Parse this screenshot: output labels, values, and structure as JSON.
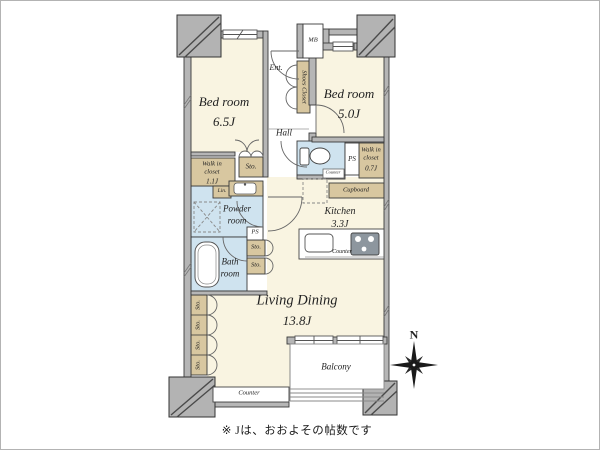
{
  "rooms": {
    "bedroom_a": {
      "name": "Bed room",
      "size": "6.5J"
    },
    "bedroom_b": {
      "name": "Bed room",
      "size": "5.0J"
    },
    "living_dining": {
      "name": "Living Dining",
      "size": "13.8J"
    },
    "kitchen": {
      "name": "Kitchen",
      "size": "3.3J"
    },
    "bath": {
      "line1": "Bath",
      "line2": "room"
    },
    "powder": {
      "line1": "Powder",
      "line2": "room"
    },
    "hall": {
      "name": "Hall"
    },
    "entrance": {
      "name": "Ent."
    },
    "balcony": {
      "name": "Balcony"
    },
    "wic_a": {
      "line1": "Walk in",
      "line2": "closet",
      "size": "1.1J"
    },
    "wic_b": {
      "line1": "Walk in",
      "line2": "closet",
      "size": "0.7J"
    }
  },
  "labels": {
    "mb": "MB",
    "shoes_closet": "Shoes Closet",
    "sto": "Sto.",
    "lin": "Lin.",
    "ps": "PS",
    "cupboard": "Cupboard",
    "counter": "Counter"
  },
  "compass": {
    "north": "N"
  },
  "footnote": "※ Jは、おおよその帖数です",
  "colors": {
    "floor_cream": "#f9f4e1",
    "closet_tan": "#d8c7a0",
    "wet_blue": "#cfe3ef",
    "wall_gray": "#b6b6b6",
    "line_dark": "#3a3a3a"
  }
}
